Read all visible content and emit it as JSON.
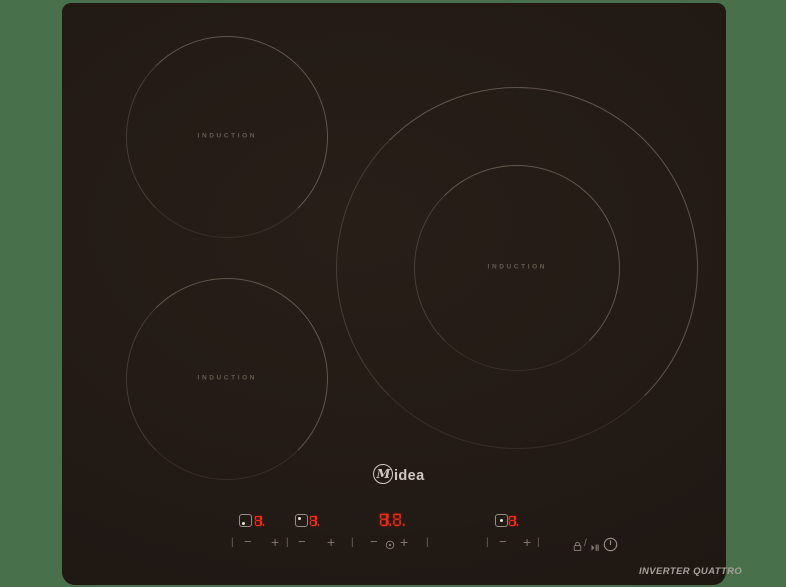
{
  "page": {
    "background_color": "#48714b"
  },
  "cooktop": {
    "surface_color": "#221a15",
    "brand_logo": {
      "m": "M",
      "rest": "idea",
      "color": "#cfc8c1"
    },
    "model_label": "INVERTER QUATTRO",
    "zones": [
      {
        "name": "top-left",
        "label": "INDUCTION"
      },
      {
        "name": "bottom-left",
        "label": "INDUCTION"
      },
      {
        "name": "right-dual",
        "label": "INDUCTION"
      }
    ],
    "control_panel": {
      "led_color": "#f22a18",
      "displays": {
        "bottom_left": "8.",
        "top_left": "8.",
        "timer": "8.8.",
        "right": "8."
      },
      "symbols": {
        "minus": "−",
        "plus": "+",
        "separator": "|",
        "slash": "/"
      },
      "keys": [
        {
          "name": "lock-pause",
          "icons": [
            "lock",
            "pause"
          ],
          "divider": "/"
        },
        {
          "name": "power",
          "icon": "power-circle"
        },
        {
          "name": "timer",
          "icon": "clock"
        }
      ]
    }
  }
}
